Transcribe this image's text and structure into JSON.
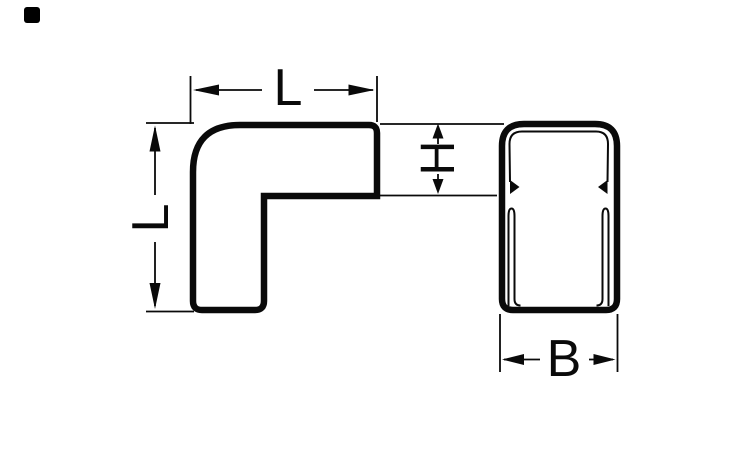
{
  "page": {
    "background_color": "#ffffff"
  },
  "corner_marker": {
    "color": "#000000"
  },
  "drawing": {
    "stroke_color": "#0a0a0a",
    "fill_color": "#ffffff",
    "dimensions": {
      "top_length": {
        "label": "L"
      },
      "left_length": {
        "label": "L"
      },
      "arm_height": {
        "label": "H"
      },
      "profile_width": {
        "label": "B"
      }
    }
  }
}
